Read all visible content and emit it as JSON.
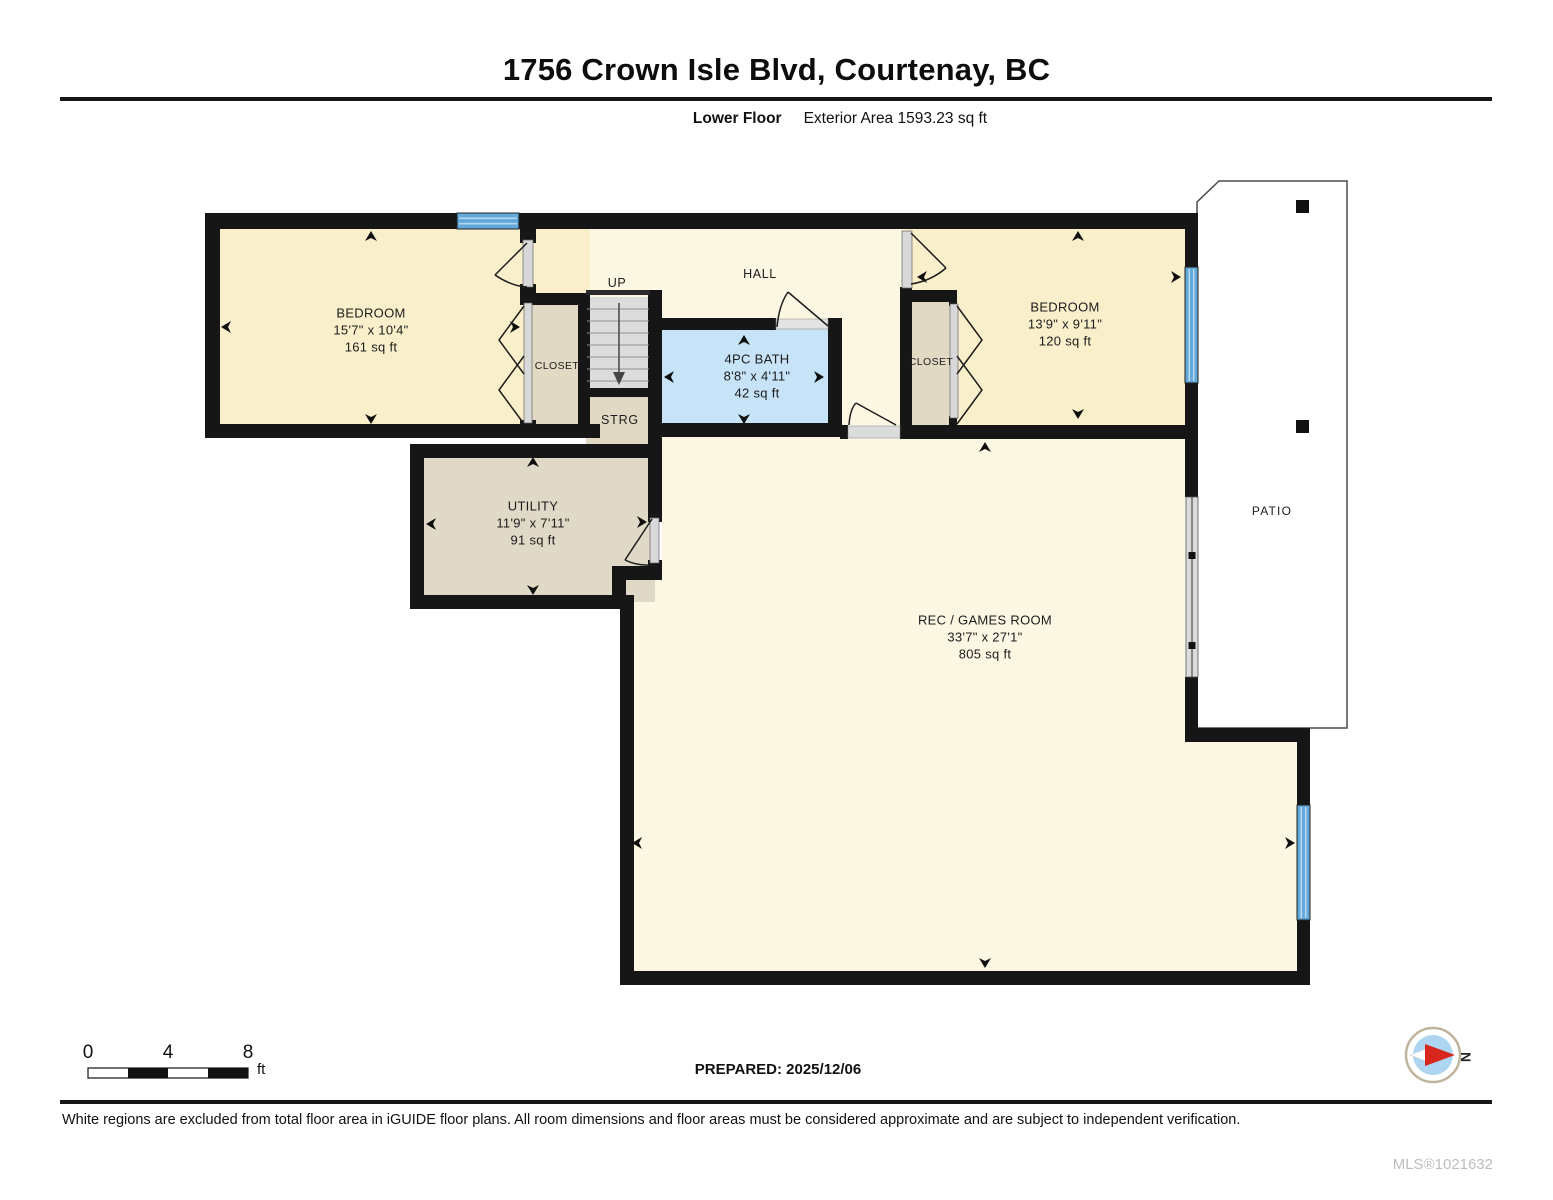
{
  "header": {
    "title": "1756 Crown Isle Blvd, Courtenay, BC",
    "floor_label": "Lower Floor",
    "area_label": "Exterior Area 1593.23 sq ft"
  },
  "rooms": {
    "bedroom1": {
      "name": "BEDROOM",
      "dims": "15'7\" x 10'4\"",
      "area": "161 sq ft"
    },
    "bedroom2": {
      "name": "BEDROOM",
      "dims": "13'9\" x 9'11\"",
      "area": "120 sq ft"
    },
    "bath": {
      "name": "4PC BATH",
      "dims": "8'8\" x 4'11\"",
      "area": "42 sq ft"
    },
    "utility": {
      "name": "UTILITY",
      "dims": "11'9\" x 7'11\"",
      "area": "91 sq ft"
    },
    "rec_room": {
      "name": "REC / GAMES ROOM",
      "dims": "33'7\" x 27'1\"",
      "area": "805 sq ft"
    },
    "hall": {
      "name": "HALL"
    },
    "stairs": {
      "name": "UP"
    },
    "closet_left": {
      "name": "CLOSET"
    },
    "closet_right": {
      "name": "CLOSET"
    },
    "storage": {
      "name": "STRG"
    },
    "patio": {
      "name": "PATIO"
    }
  },
  "scale_bar": {
    "ticks": [
      "0",
      "4",
      "8"
    ],
    "unit": "ft"
  },
  "compass": {
    "north_label": "N"
  },
  "prepared_label": "PREPARED: 2025/12/06",
  "footer": {
    "disclaimer": "White regions are excluded from total floor area in iGUIDE floor plans. All room dimensions and floor areas must be considered approximate and are subject to independent verification.",
    "mls": "MLS®1021632"
  },
  "colors": {
    "wall": "#161616",
    "bedroom_fill": "#FAEFCB",
    "hall_fill": "#FCF7E2",
    "bath_fill": "#C6E3F7",
    "closet_fill": "#E2D9C4",
    "utility_fill": "#E0D9C8",
    "stairs_fill": "#DCDCDC",
    "window_blue": "#62A8DB",
    "patio_fill": "#FFFFFF",
    "compass_blue": "#AED6F2",
    "compass_red": "#D8261C",
    "mls_gray": "#BDBDBD"
  }
}
